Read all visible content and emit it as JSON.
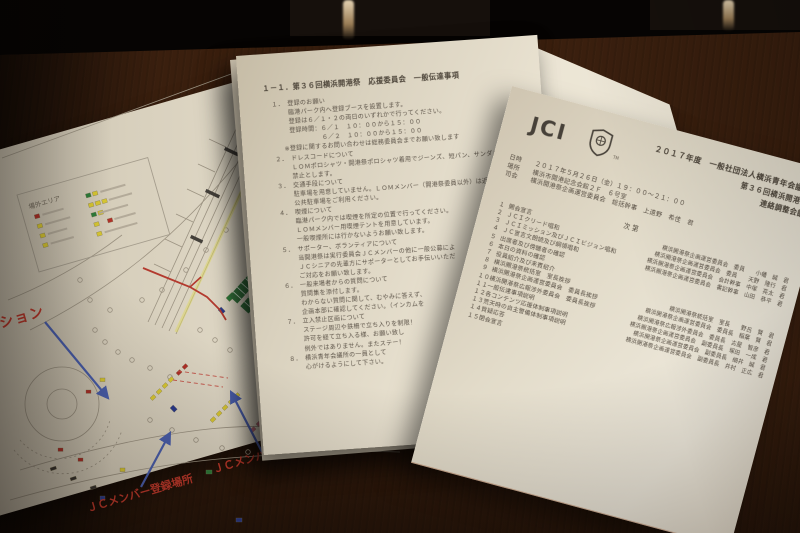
{
  "colors": {
    "handwriting_red": "#c0392b",
    "arrow_blue": "#4a5fae",
    "booth_yellow": "#d9c832",
    "booth_red": "#b03028",
    "booth_green": "#2e7d3a",
    "booth_blue": "#2a3a8c",
    "route_red": "#b33a2e"
  },
  "map_doc": {
    "legend_title": "場外エリア",
    "annotations": {
      "station_partial": "ション",
      "register_spot": "ＪＣメンバー登録場所",
      "member": "ＪＣメンバー"
    }
  },
  "middle_doc": {
    "title": "１－１．第３６回横浜開港祭　応援委員会　一般伝達事項",
    "lines": [
      {
        "c": "ml-num",
        "t": "１．　登録のお願い"
      },
      {
        "c": "ml-sub",
        "t": "臨港パーク内へ登録ブースを設置します。"
      },
      {
        "c": "ml-sub",
        "t": "登録は６／１・２の両日のいずれかで行ってください。"
      },
      {
        "c": "ml-sub",
        "t": "登録時間：６／１　１０：００から１５：００"
      },
      {
        "c": "ml-sub2",
        "t": "６／２　１０：００から１５：００"
      },
      {
        "c": "ml-note",
        "t": "※登録に関するお問い合わせは総務委員会までお願い致します"
      },
      {
        "c": "ml-num",
        "t": "２．　ドレスコードについて"
      },
      {
        "c": "ml-sub",
        "t": "ＬＯＭポロシャツ・開港祭ポロシャツ着用でジーンズ、短パン、サンダルは"
      },
      {
        "c": "ml-sub",
        "t": "禁止とします。"
      },
      {
        "c": "ml-num",
        "t": "３．　交通手段について"
      },
      {
        "c": "ml-sub",
        "t": "駐車場を用意していません。ＬＯＭメンバー（開港祭委員以外）は近隣"
      },
      {
        "c": "ml-sub",
        "t": "公共駐車場をご利用ください。"
      },
      {
        "c": "ml-num",
        "t": "４．　喫煙について"
      },
      {
        "c": "ml-sub",
        "t": "臨港パーク内では喫煙を所定の位置で行ってください。"
      },
      {
        "c": "ml-sub",
        "t": "ＬＯＭメンバー用喫煙テントを用意しています。"
      },
      {
        "c": "ml-sub",
        "t": "一般喫煙所には行かないようお願い致します。"
      },
      {
        "c": "ml-num",
        "t": "５．　サポーター、ボランティアについて"
      },
      {
        "c": "ml-sub",
        "t": "当開港祭は実行委員会ＪＣメンバーの他に一般公募によ"
      },
      {
        "c": "ml-sub",
        "t": "ＪＣシニアの先輩方にサポーターとしてお手伝いいただ"
      },
      {
        "c": "ml-sub",
        "t": "ご対応をお願い致します。"
      },
      {
        "c": "ml-num",
        "t": "６．　一般来場者からの質問について"
      },
      {
        "c": "ml-sub",
        "t": "質問集を添付します。"
      },
      {
        "c": "ml-sub",
        "t": "わからない質問に関して、むやみに答えず、"
      },
      {
        "c": "ml-sub",
        "t": "企画本部に確認してください。（インカムを"
      },
      {
        "c": "ml-num",
        "t": "７．　立入禁止区画について"
      },
      {
        "c": "ml-sub",
        "t": "ステージ周辺や鉄柵で立ち入りを制限！"
      },
      {
        "c": "ml-sub",
        "t": "許可を経て立ち入る様、お願い致し"
      },
      {
        "c": "ml-sub",
        "t": "例外ではありません。またステー！"
      },
      {
        "c": "ml-num",
        "t": "８．　横浜青年会議所の一員として"
      },
      {
        "c": "ml-sub",
        "t": "心がけるようにして下さい。"
      }
    ]
  },
  "right_doc": {
    "logo": "JCI",
    "logo_tm": "TM",
    "title_line1": "２０１７年度　一般社団法人横浜青年会議所",
    "title_line2": "第３６回横浜開港祭",
    "title_line3": "連絡調整会議",
    "info": [
      {
        "label": "日時",
        "value": "２０１７年５月２６日（金）１９：００～２１：００"
      },
      {
        "label": "場所",
        "value": "横浜市開港記念会館２Ｆ　６号室"
      },
      {
        "label": "司会",
        "value": "横浜開港祭企画運営委員会　総括幹事　上遠野　希佳　君"
      }
    ],
    "agenda_header": "次第",
    "agenda": [
      {
        "n": "１",
        "t": "開会宣言",
        "s": "横浜開港祭企画運営委員会　委員　　小幡　誠　君"
      },
      {
        "n": "２",
        "t": "ＪＣＩクリード唱和",
        "s": "横浜開港祭企画運営委員会　委員　　天野　隆行　君"
      },
      {
        "n": "３",
        "t": "ＪＣＩミッション及びＪＣＩビジョン唱和",
        "s": "横浜開港祭企画運営委員会　会計幹事　中塚　亮太　君"
      },
      {
        "n": "４",
        "t": "ＪＣ宣言文朗読及び綱領唱和",
        "s": "横浜開港祭企画運営委員会　書記幹事　山田　恭平　君"
      },
      {
        "n": "５",
        "t": "出席者及び傍聴者の確認",
        "s": ""
      },
      {
        "n": "６",
        "t": "本日の資料の確認",
        "s": ""
      },
      {
        "n": "７",
        "t": "役員紹介及び来賓紹介",
        "s": ""
      },
      {
        "n": "８",
        "t": "横浜開港祭統括室　室長挨拶",
        "s": "横浜開港祭統括室　室長　　野呂　賢　君"
      },
      {
        "n": "９",
        "t": "横浜開港祭企画運営委員会　委員長挨拶",
        "s": "横浜開港祭企画運営委員会　委員長　稲葉　賢　君"
      },
      {
        "n": "１０",
        "t": "横浜開港祭広報渉外委員会　委員長挨拶",
        "s": "横浜開港祭広報渉外委員会　委員長　古屋　智彦　君"
      },
      {
        "n": "１１",
        "t": "一般伝達事項説明",
        "s": "横浜開港祭企画運営委員会　副委員長　塚田　一成　君"
      },
      {
        "n": "１２",
        "t": "各コンテンツ応援体制事項説明",
        "s": "横浜開港祭企画運営委員会　副委員長　細井　誠　君"
      },
      {
        "n": "１３",
        "t": "荒天時の自主警備体制事項説明",
        "s": "横浜開港祭企画運営委員会　副委員長　井村　正広　君"
      },
      {
        "n": "１４",
        "t": "質疑応答",
        "s": ""
      },
      {
        "n": "１５",
        "t": "閉会宣言",
        "s": ""
      }
    ]
  }
}
